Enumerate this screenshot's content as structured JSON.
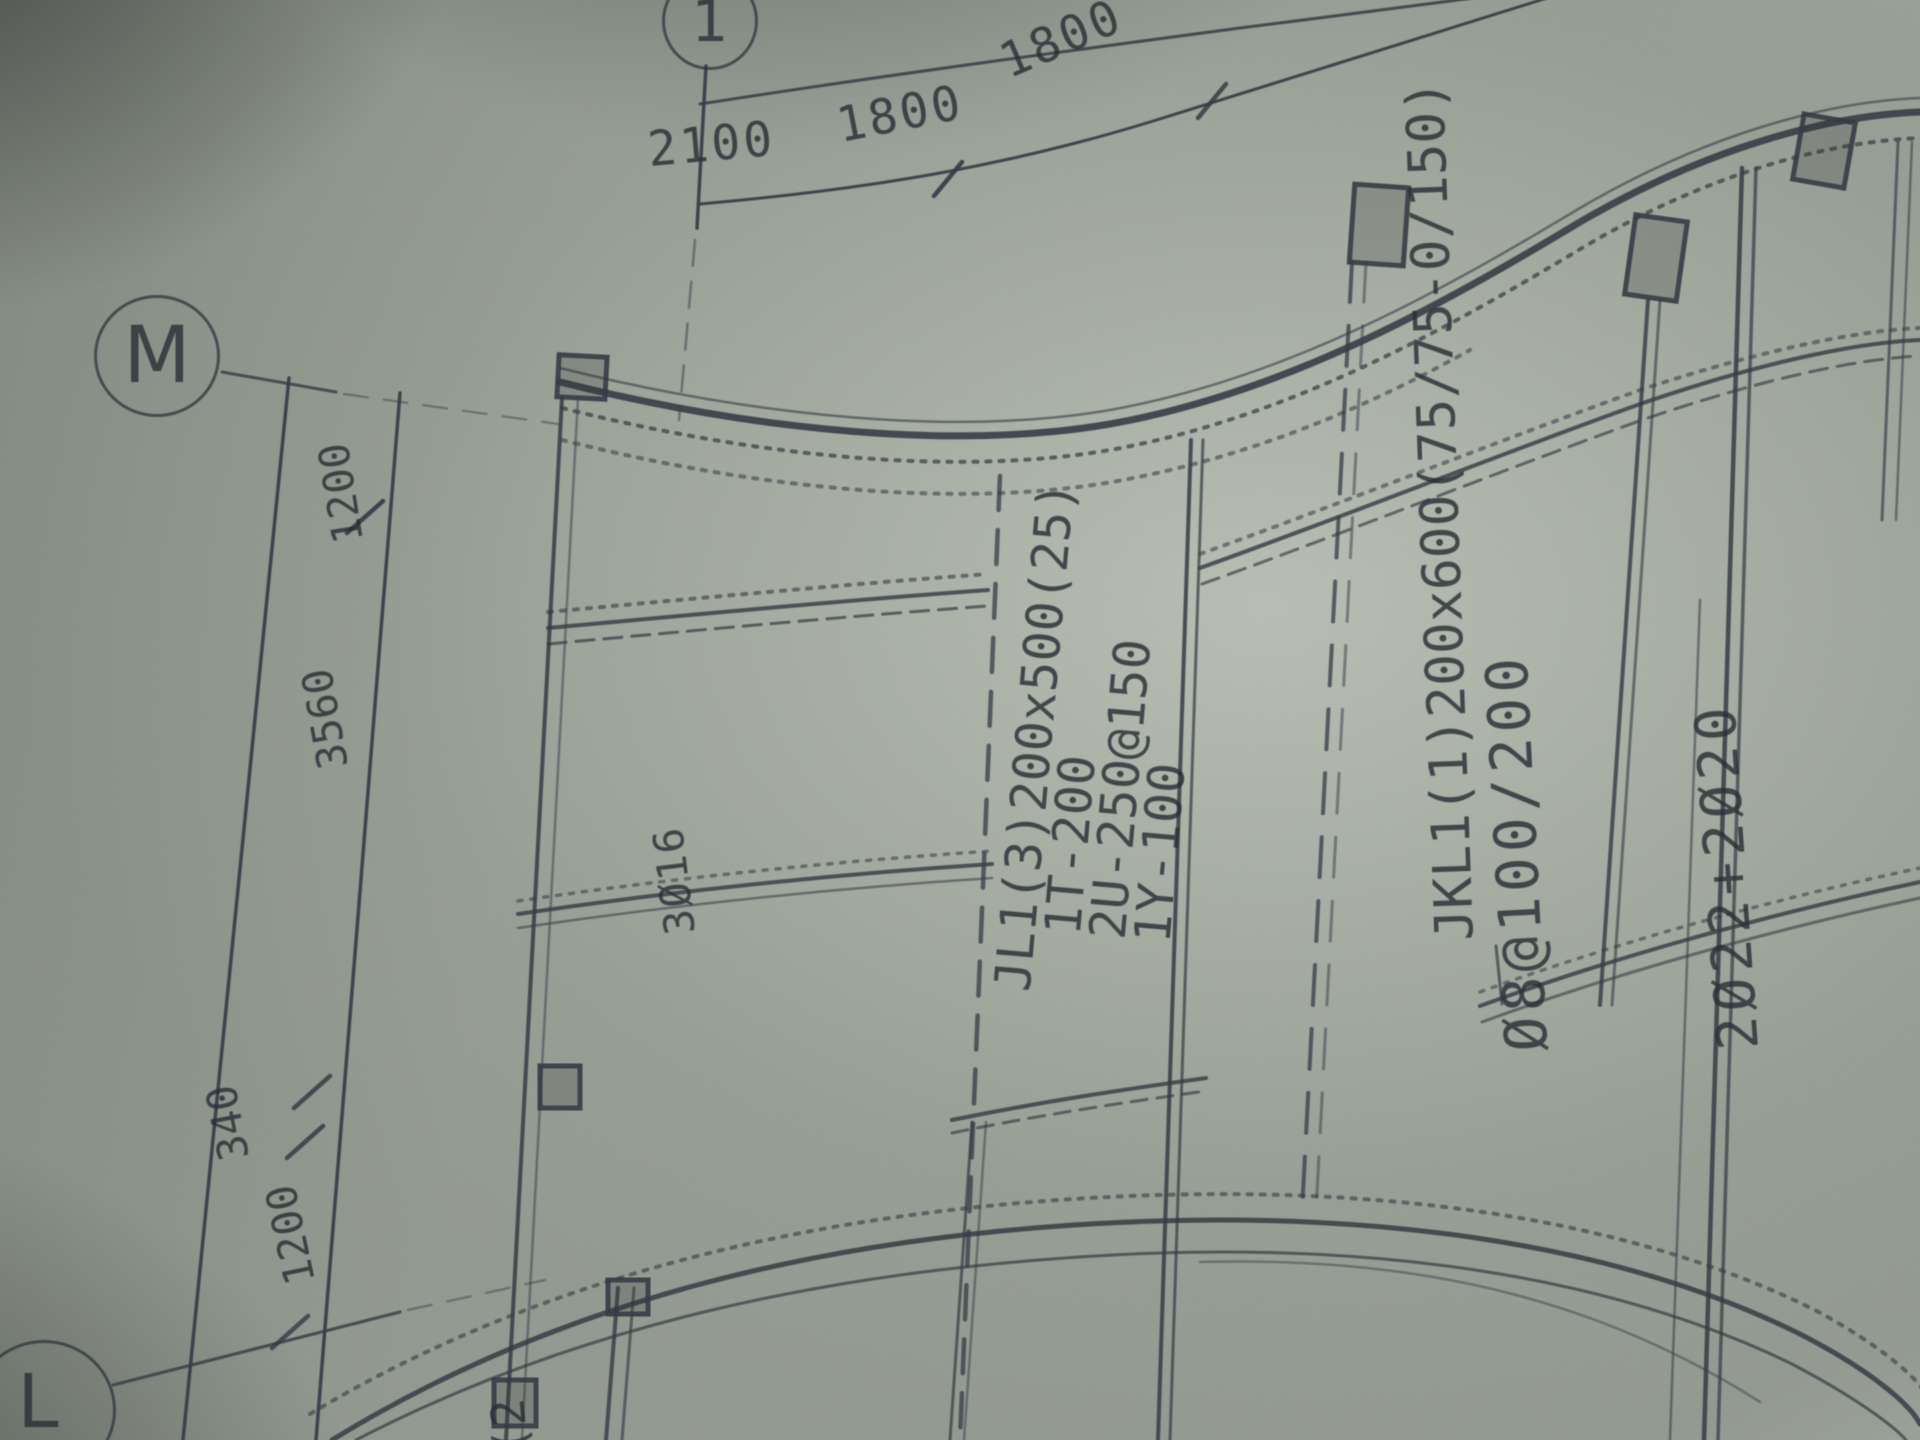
{
  "drawing": {
    "paper_color": "#99a097",
    "ink_color": "#2f363d",
    "grid_bubbles": {
      "top": "1",
      "mid_left": "M",
      "bottom_left": "L",
      "bottom_center_partial": "(2"
    },
    "dims_top": [
      "2100",
      "1800",
      "1800"
    ],
    "dims_left": [
      "1200",
      "3560",
      "340",
      "1200"
    ],
    "labels": {
      "slab_bars": "3Ø16",
      "beam_group": "JL1(3)200x500(25)\n  1T-200\n  2U-250@150\n  1Y-100",
      "arc_beam": "JKL1(1)200x600(75/75-0/150)",
      "arc_beam_stirrups": "Ø8@100/200",
      "arc_beam_bars": "2Ø22+2Ø20"
    }
  }
}
